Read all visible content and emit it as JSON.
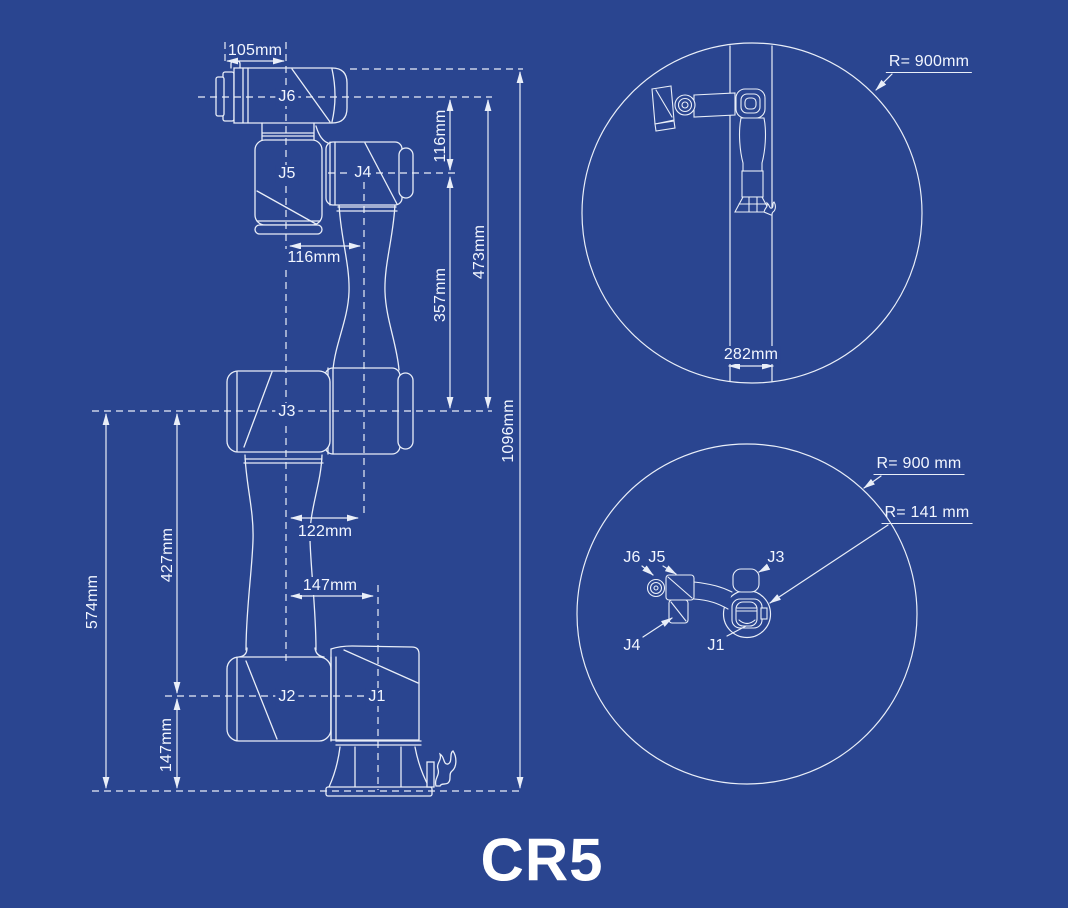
{
  "title": "CR5",
  "colors": {
    "background": "#2A4590",
    "line": "#E9EEF8",
    "text": "#F2F6FF"
  },
  "side_view": {
    "joints": {
      "j1": "J1",
      "j2": "J2",
      "j3": "J3",
      "j4": "J4",
      "j5": "J5",
      "j6": "J6"
    },
    "dims": {
      "d105": "105mm",
      "d116_vertical": "116mm",
      "d116_horizontal": "116mm",
      "d357": "357mm",
      "d473": "473mm",
      "d1096": "1096mm",
      "d122": "122mm",
      "d147_horizontal": "147mm",
      "d427": "427mm",
      "d574": "574mm",
      "d147_vertical": "147mm"
    }
  },
  "front_view": {
    "reach_radius": "R= 900mm",
    "base_column_width": "282mm"
  },
  "top_view": {
    "outer_radius": "R= 900 mm",
    "inner_radius": "R= 141 mm",
    "joints": {
      "j1": "J1",
      "j3": "J3",
      "j4": "J4",
      "j5": "J5",
      "j6": "J6"
    }
  }
}
